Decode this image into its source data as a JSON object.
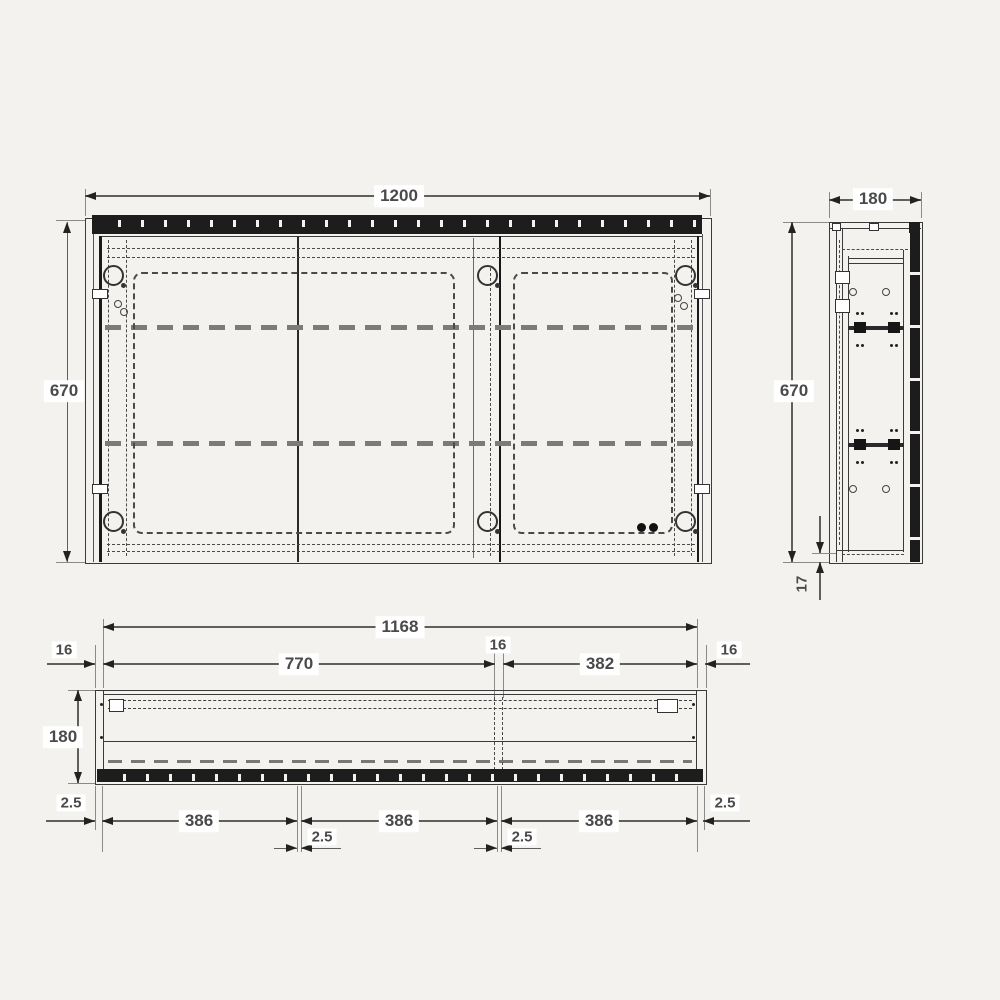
{
  "drawing_type": "cabinet technical dimension drawing",
  "colors": {
    "background": "#f3f2ee",
    "line": "#3a3a3a",
    "dashed_line": "#4a4a4a",
    "shelf_dash": "#7b7b7b",
    "dark_fill": "#1d1d1d",
    "label_bg": "#ffffff",
    "label_text": "#4a4a4a"
  },
  "views": {
    "front": {
      "name": "front elevation",
      "width_mm": "1200",
      "height_mm": "670"
    },
    "side": {
      "name": "side section",
      "width_mm": "180",
      "height_mm": "670",
      "bottom_offset_mm": "17"
    },
    "plan": {
      "name": "plan section",
      "inner_width_mm": "1168",
      "wall_left_mm": "16",
      "compartment_left_mm": "770",
      "partition_mm": "16",
      "compartment_right_mm": "382",
      "wall_right_mm": "16",
      "depth_mm": "180",
      "edge_gap_left_mm": "2.5",
      "edge_gap_right_mm": "2.5",
      "door_widths_mm": [
        "386",
        "386",
        "386"
      ],
      "door_gaps_mm": [
        "2.5",
        "2.5"
      ]
    }
  }
}
